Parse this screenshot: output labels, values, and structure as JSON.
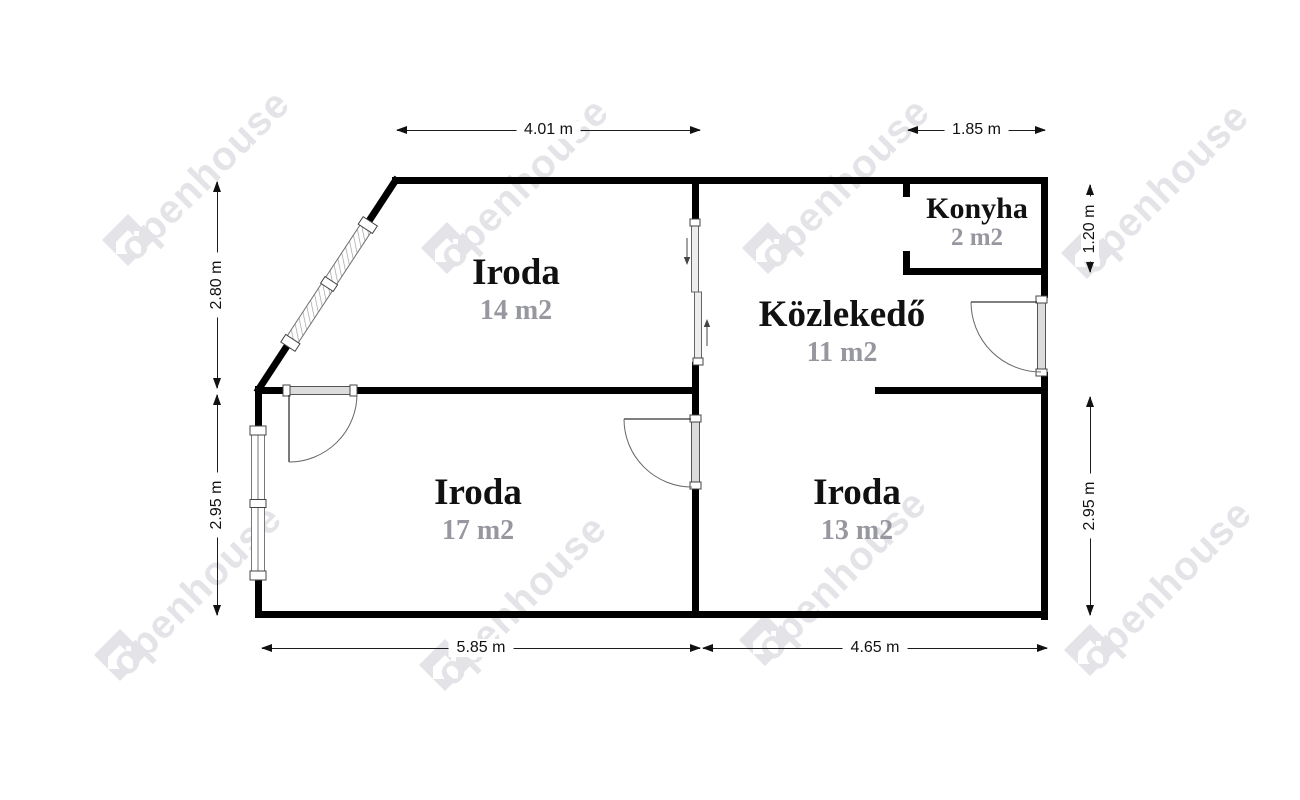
{
  "watermark": {
    "text": "openhouse"
  },
  "rooms": [
    {
      "name": "Iroda",
      "area": "14 m2"
    },
    {
      "name": "Közlekedő",
      "area": "11 m2"
    },
    {
      "name": "Konyha",
      "area": "2 m2"
    },
    {
      "name": "Iroda",
      "area": "17 m2"
    },
    {
      "name": "Iroda",
      "area": "13 m2"
    }
  ],
  "dimensions": {
    "top_left": "4.01 m",
    "top_right": "1.85 m",
    "left_upper": "2.80 m",
    "left_lower": "2.95 m",
    "right_upper": "1.20 m",
    "right_lower": "2.95 m",
    "bottom_left": "5.85 m",
    "bottom_right": "4.65 m"
  },
  "colors": {
    "wall": "#000000",
    "area_text": "#97979f",
    "watermark": "#e4e4e8"
  }
}
